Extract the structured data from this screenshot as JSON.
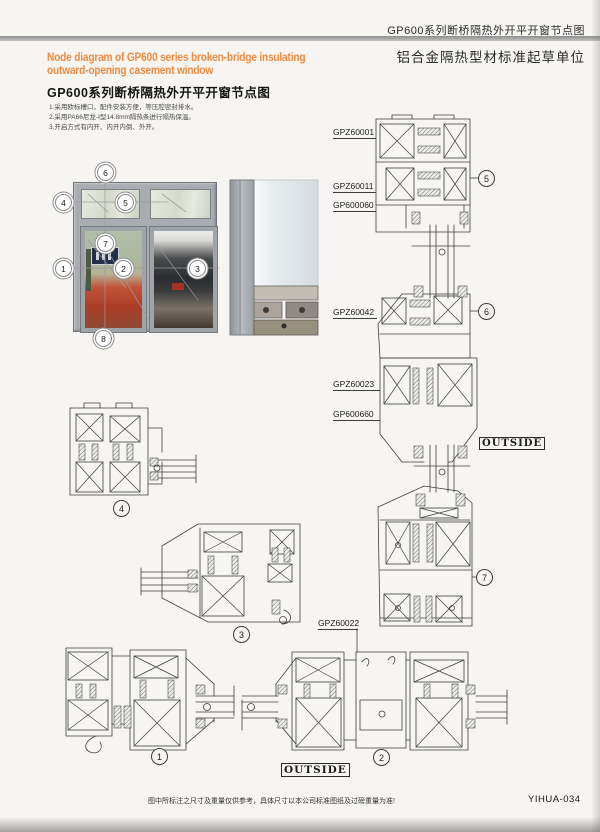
{
  "header": {
    "series_title": "GP600系列断桥隔热外开平开窗节点图",
    "org_title": "铝合金隔热型材标准起草单位"
  },
  "title_block": {
    "en_line1": "Node diagram of GP600 series broken-bridge insulating",
    "en_line2": "outward-opening casement window",
    "zh_title": "GP600系列断桥隔热外开平开窗节点图",
    "note1": "1.采用欧标槽口，配件安装方便，等压腔密封排水。",
    "note2": "2.采用PA66尼龙-Ⅰ型14.8mm隔热条进行隔热保温。",
    "note3": "3.开启方式有内开、内开内倒、外开。"
  },
  "profile_labels": {
    "gpz60001": "GPZ60001",
    "gpz60011": "GPZ60011",
    "gp600060": "GP600060",
    "gpz60042": "GPZ60042",
    "gpz60023": "GPZ60023",
    "gp600660": "GP600660",
    "gpz60022": "GPZ60022"
  },
  "outside_label": "OUTSIDE",
  "callouts": {
    "c1": "1",
    "c2": "2",
    "c3": "3",
    "c4": "4",
    "c5": "5",
    "c6": "6",
    "c7": "7",
    "c8": "8"
  },
  "footer": {
    "disclaimer": "图中所标注之尺寸及重量仅供参考，具体尺寸以本公司标准图纸及过磅重量为准!",
    "page_code": "YIHUA-034"
  },
  "colors": {
    "accent_orange": "#ef8c3f",
    "line_color": "#3f3f3f",
    "frame_gray": "#a9adb1"
  }
}
